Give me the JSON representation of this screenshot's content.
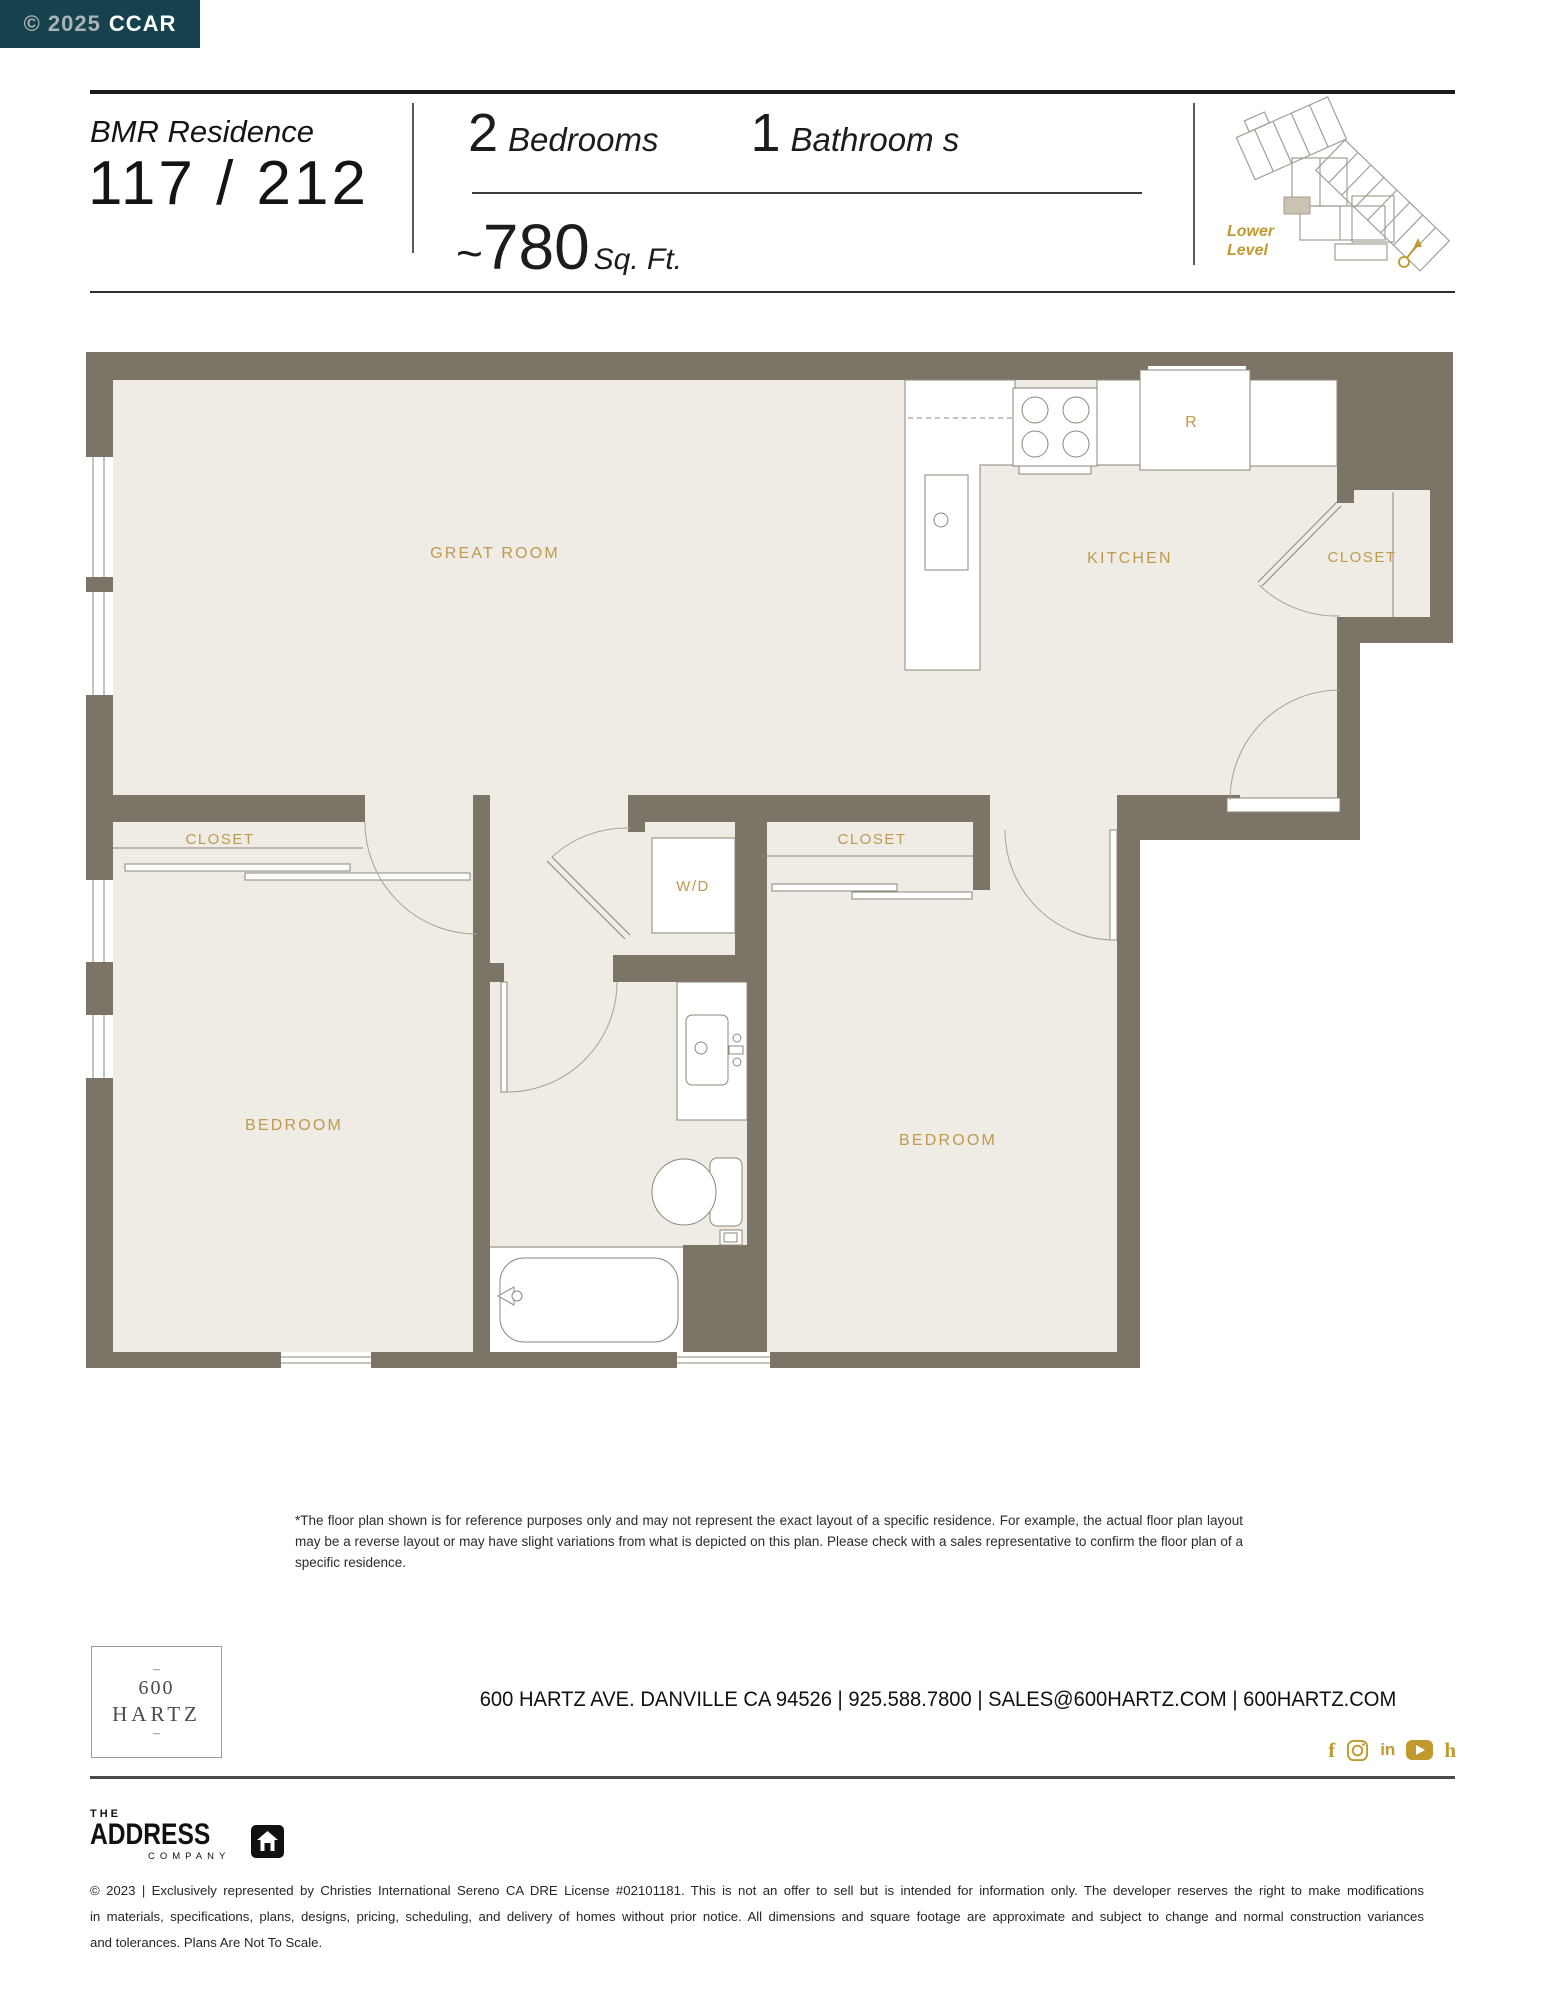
{
  "badge": {
    "muted": "© 2025",
    "brand": "CCAR"
  },
  "header": {
    "residence_label": "BMR Residence",
    "residence_number": "117 / 212",
    "bedrooms_value": "2",
    "bedrooms_label": "Bedrooms",
    "bathrooms_value": "1",
    "bathrooms_label": "Bathroom s",
    "sqft_tilde": "~",
    "sqft_value": "780",
    "sqft_unit": "Sq. Ft.",
    "level_line1": "Lower",
    "level_line2": "Level"
  },
  "plan": {
    "labels": {
      "great_room": "GREAT ROOM",
      "kitchen": "KITCHEN",
      "closet_entry": "CLOSET",
      "closet_bed1": "CLOSET",
      "closet_bed2": "CLOSET",
      "wd": "W/D",
      "bedroom_left": "BEDROOM",
      "bedroom_right": "BEDROOM",
      "fridge": "R"
    },
    "colors": {
      "wall": "#7c7467",
      "floor": "#eeece5",
      "fixture_stroke": "#8d8578",
      "label_gold": "#bf9a4e"
    }
  },
  "disclaimer": "*The floor plan shown is for reference purposes only and may not represent the exact layout of a specific residence. For example, the actual floor plan layout may be a reverse layout or may have slight variations from what is depicted on this plan. Please check with a sales representative to confirm the floor plan of a specific residence.",
  "footer": {
    "logo": {
      "dash": "–",
      "line1": "600",
      "line2": "HARTZ"
    },
    "address_line": "600 HARTZ AVE. DANVILLE CA 94526 | 925.588.7800 | SALES@600HARTZ.COM | 600HARTZ.COM",
    "social": [
      "facebook-icon",
      "instagram-icon",
      "linkedin-icon",
      "youtube-icon",
      "houzz-icon"
    ],
    "social_f": "f",
    "social_in": "in",
    "social_h": "h",
    "brokerage": {
      "the": "THE",
      "address": "ADDRESS",
      "company": "COMPANY"
    },
    "legal_line1": "© 2023 | Exclusively represented by Christies International Sereno CA DRE License #02101181. This is not an offer to sell but is intended for information only. The developer reserves the right to make modifications",
    "legal_line2": "in materials, specifications, plans, designs, pricing, scheduling, and delivery of homes without prior notice. All dimensions and square footage are approximate and subject to change and normal construction variances",
    "legal_line3": "and tolerances. Plans Are Not To Scale."
  },
  "colors": {
    "badge_teal": "#16424e",
    "accent_gold": "#c0992e",
    "social_gold": "#c2992e"
  }
}
